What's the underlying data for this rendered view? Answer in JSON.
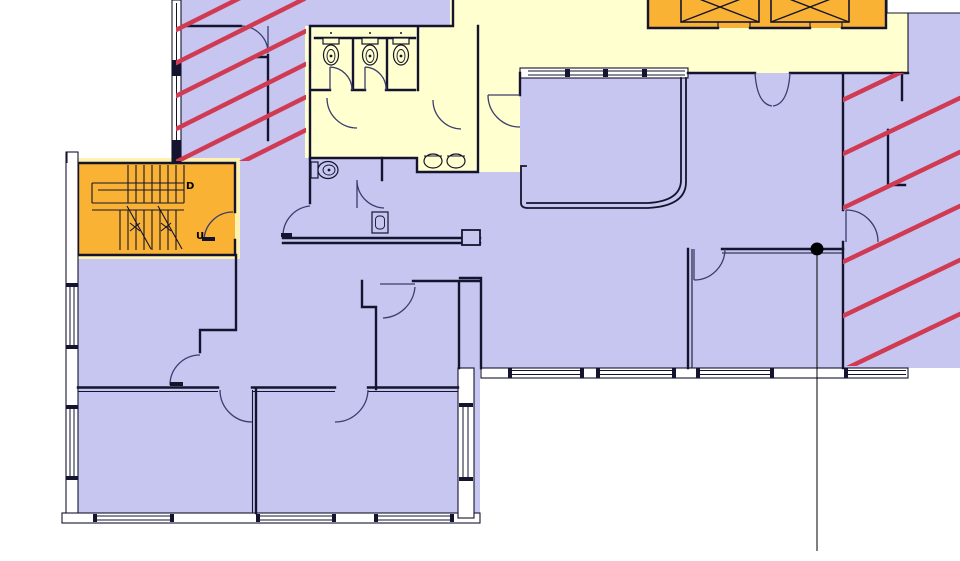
{
  "drawing": {
    "kind": "architectural-floor-plan",
    "stair": {
      "down_label": "D",
      "up_label": "U"
    },
    "colors": {
      "room_fill": "#c6c6f1",
      "corridor_fill": "#ffffcf",
      "core_fill": "#f9b233",
      "core_halo": "#fdf2b0",
      "hatch_color": "#d03a52",
      "wall_color": "#14142e",
      "door_color": "#3c3c6e",
      "outside": "#ffffff"
    },
    "zones": [
      {
        "name": "hatched-room-top-left",
        "fill": "#c6c6f1",
        "hatched": true
      },
      {
        "name": "hatched-room-right",
        "fill": "#c6c6f1",
        "hatched": true
      },
      {
        "name": "corridor-and-restrooms",
        "fill": "#ffffcf",
        "hatched": false
      },
      {
        "name": "stairwell",
        "fill": "#f9b233",
        "hatched": false
      },
      {
        "name": "elevator-core",
        "fill": "#f9b233",
        "hatched": false
      },
      {
        "name": "offices",
        "fill": "#c6c6f1",
        "hatched": false
      }
    ],
    "fixtures": {
      "wc_stalls": 3,
      "stall_toilets": 3,
      "sinks": 2,
      "accessible_wc_toilets": 1,
      "urinals": 1,
      "elevator_cars": 2
    },
    "annotation": {
      "marker": "reference-dot-with-leader-line"
    }
  }
}
